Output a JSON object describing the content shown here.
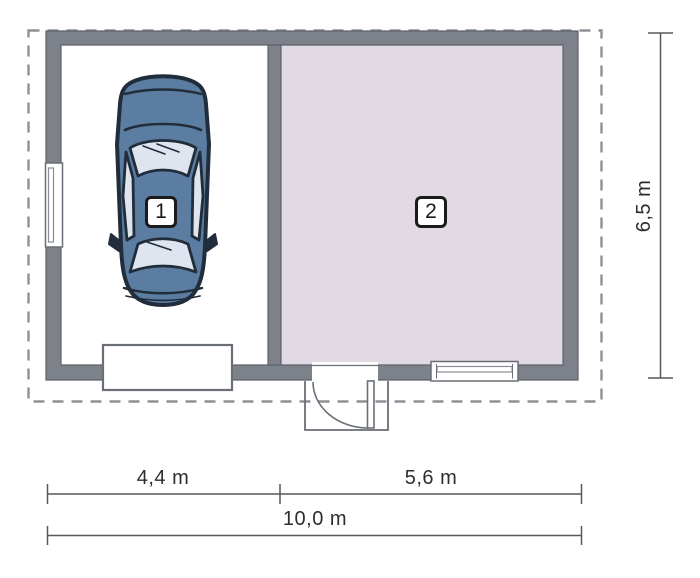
{
  "figure": {
    "type": "floor-plan",
    "rooms": [
      {
        "label": "1"
      },
      {
        "label": "2"
      }
    ],
    "dimensions": {
      "bottom_left_width": "4,4 m",
      "bottom_right_width": "5,6 m",
      "bottom_total_width": "10,0 m",
      "right_height": "6,5 m"
    },
    "colors": {
      "wall": "#7d818a",
      "wall_edge": "#5e626b",
      "room2_fill": "#e2dae2",
      "dash": "#8d9196",
      "symbol_line": "#6a6e76",
      "dim_line": "#55585c",
      "text": "#2d2d2d",
      "car_body": "#5a7da1",
      "car_glass": "#dfe5ef",
      "car_outline": "#222d3b"
    }
  }
}
